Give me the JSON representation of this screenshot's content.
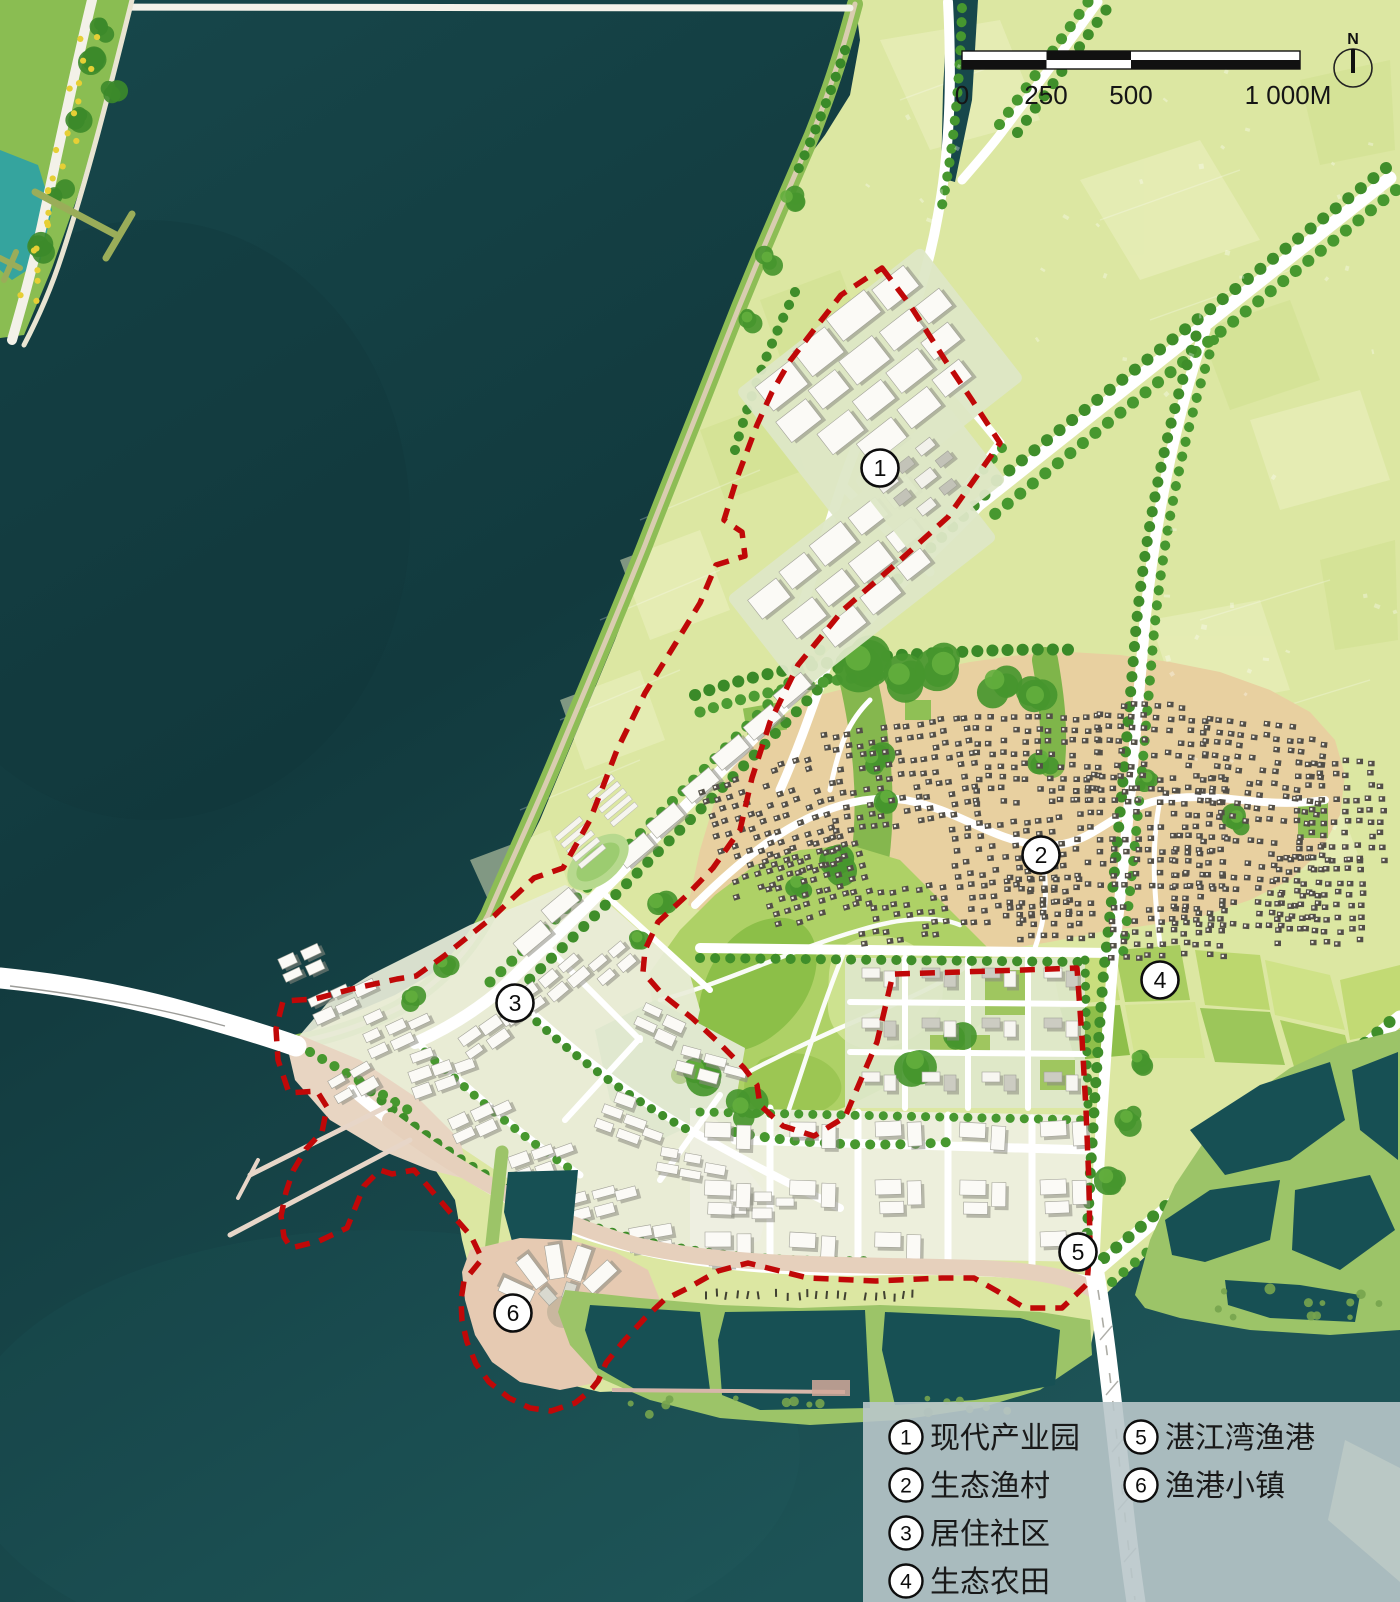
{
  "map_type": "urban-master-plan-aerial",
  "compass": {
    "label": "N"
  },
  "scalebar": {
    "labels": [
      "0",
      "250",
      "500",
      "1 000M"
    ]
  },
  "legend": {
    "items": [
      {
        "num": "1",
        "label": "现代产业园"
      },
      {
        "num": "2",
        "label": "生态渔村"
      },
      {
        "num": "3",
        "label": "居住社区"
      },
      {
        "num": "4",
        "label": "生态农田"
      },
      {
        "num": "5",
        "label": "湛江湾渔港"
      },
      {
        "num": "6",
        "label": "渔港小镇"
      }
    ]
  },
  "markers": [
    {
      "num": "1",
      "label": "现代产业园",
      "x": 880,
      "y": 468
    },
    {
      "num": "2",
      "label": "生态渔村",
      "x": 1041,
      "y": 855
    },
    {
      "num": "3",
      "label": "居住社区",
      "x": 515,
      "y": 1003
    },
    {
      "num": "4",
      "label": "生态农田",
      "x": 1160,
      "y": 980
    },
    {
      "num": "5",
      "label": "湛江湾渔港",
      "x": 1078,
      "y": 1252
    },
    {
      "num": "6",
      "label": "渔港小镇",
      "x": 513,
      "y": 1313
    }
  ],
  "colors": {
    "water": "#143f43",
    "land_pale": "#dce7a2",
    "boundary_red": "#c00808",
    "village_ground": "#e8d0a0",
    "park_green": "#aed166",
    "pond_dike_green": "#9cc468",
    "quay_pink": "#e6d0bc",
    "legend_panel": "#b9c7ca"
  }
}
